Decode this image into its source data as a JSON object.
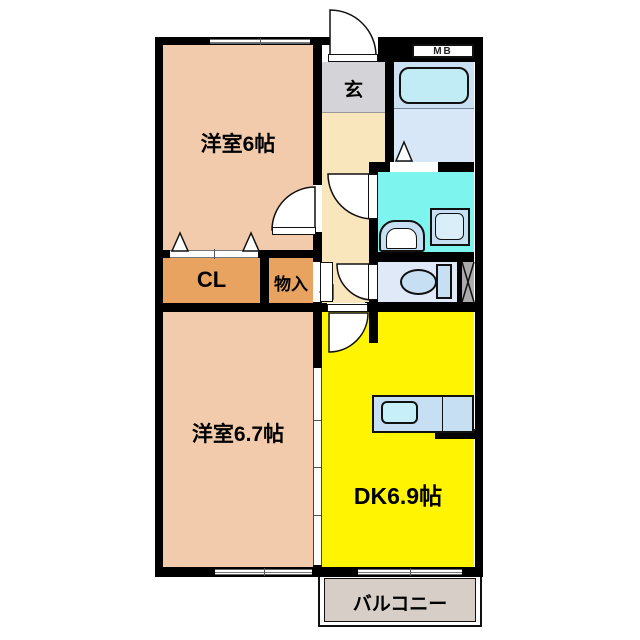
{
  "title": "2DK apartment floor plan",
  "palette": {
    "wall": "#000000",
    "room_peach": "#F1CBAB",
    "hall_cream": "#FAE6BD",
    "entry_gray": "#D4D4D8",
    "closet_orange": "#E9A361",
    "bath_blue": "#D8E7F7",
    "bath_upper": "#CCE0F4",
    "tub_cyan": "#C2ECF5",
    "wash_aqua": "#7EF4EF",
    "fixture_blue": "#C7DFF3",
    "fixture_light": "#D9EEF9",
    "sink_cyan": "#C6EFF9",
    "toilet_room": "#DFE9F8",
    "dk_yellow": "#FFF502",
    "balcony_gray": "#D7CFC7",
    "ps_gray": "#ACACAC"
  },
  "rooms": {
    "bedroom1": {
      "label": "洋室6帖"
    },
    "bedroom2": {
      "label": "洋室6.7帖"
    },
    "dining_kitchen": {
      "label": "DK6.9帖"
    },
    "entrance": {
      "label": "玄"
    },
    "closet": {
      "label": "CL"
    },
    "storage": {
      "label": "物入"
    },
    "balcony": {
      "label": "バルコニー"
    },
    "meter_box": {
      "label": "MB"
    }
  }
}
